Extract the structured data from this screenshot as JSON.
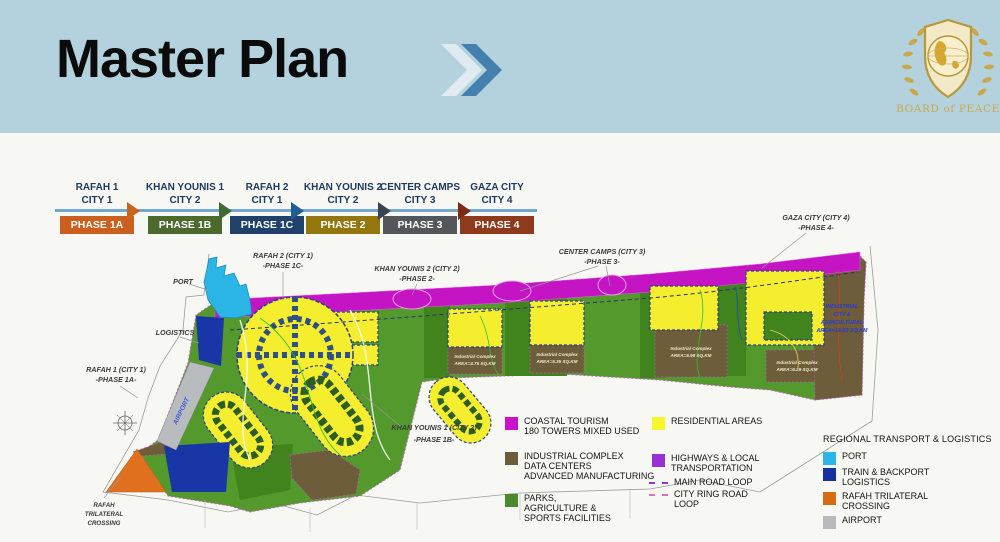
{
  "header": {
    "title": "Master Plan",
    "logo_text": "BOARD of PEACE"
  },
  "timeline": {
    "stages": [
      {
        "city_line1": "RAFAH 1",
        "city_line2": "CITY 1",
        "phase": "PHASE 1A",
        "color": "#cb5f1d"
      },
      {
        "city_line1": "KHAN YOUNIS 1",
        "city_line2": "CITY 2",
        "phase": "PHASE 1B",
        "color": "#4d6a2e"
      },
      {
        "city_line1": "RAFAH 2",
        "city_line2": "CITY 1",
        "phase": "PHASE 1C",
        "color": "#20416a"
      },
      {
        "city_line1": "KHAN YOUNIS 2",
        "city_line2": "CITY 2",
        "phase": "PHASE 2",
        "color": "#93770c"
      },
      {
        "city_line1": "CENTER CAMPS",
        "city_line2": "CITY 3",
        "phase": "PHASE 3",
        "color": "#55565a"
      },
      {
        "city_line1": "GAZA CITY",
        "city_line2": "CITY 4",
        "phase": "PHASE 4",
        "color": "#8e3a1d"
      }
    ],
    "arrows": [
      "#c9651f",
      "#3f6a33",
      "#1f5d94",
      "#3a4450",
      "#7c2a15"
    ]
  },
  "map": {
    "labels": {
      "port": "PORT",
      "logistics": "LOGISTICS",
      "airport": "AIRPORT",
      "rafah1_l1": "RAFAH 1 (CITY 1)",
      "rafah1_l2": "-PHASE 1A-",
      "rafah2_l1": "RAFAH 2 (CITY 1)",
      "rafah2_l2": "-PHASE 1C-",
      "ky1_l1": "KHAN YOUNIS 1 (CITY 2)",
      "ky1_l2": "-PHASE 1B-",
      "ky2_l1": "KHAN YOUNIS 2 (CITY 2)",
      "ky2_l2": "-PHASE 2-",
      "cc_l1": "CENTER CAMPS (CITY 3)",
      "cc_l2": "-PHASE 3-",
      "gaza_l1": "GAZA CITY (CITY 4)",
      "gaza_l2": "-PHASE 4-",
      "crossing_l1": "RAFAH",
      "crossing_l2": "TRILATERAL",
      "crossing_l3": "CROSSING"
    },
    "industrial": {
      "site1_l1": "Industrial Complex",
      "site1_l2": "AREA=4.75 SQ.KM",
      "site2_l1": "Industrial Complex",
      "site2_l2": "AREA=5.35 SQ.KM",
      "site3_l1": "Industrial Complex",
      "site3_l2": "AREA=6.98 SQ.KM",
      "site4_l1": "Industrial Complex",
      "site4_l2": "AREA=6.29 SQ.KM",
      "city_l1": "INDUSTRIAL",
      "city_l2": "CITY &",
      "city_l3": "AGRICULTURAL",
      "city_l4": "AREA=16.63 SQ.KM"
    },
    "colors": {
      "parks": "#54992b",
      "parks_dark": "#41831d",
      "residential": "#f4ee2f",
      "highway": "#c414c4",
      "industrial": "#6d5d3a",
      "port": "#2ab5e6",
      "train": "#1836a6",
      "crossing": "#e06f1e",
      "airport": "#b9bcbe"
    }
  },
  "legend": {
    "planning": {
      "coastal": {
        "c": "#cb10cb",
        "l1": "COASTAL TOURISM",
        "l2": "180 TOWERS MIXED USED"
      },
      "industrial": {
        "c": "#6d5c3b",
        "l1": "INDUSTRIAL COMPLEX",
        "l2": "DATA CENTERS",
        "l3": "ADVANCED MANUFACTURING"
      },
      "parks": {
        "c": "#4c8b2d",
        "l1": "PARKS,",
        "l2": "AGRICULTURE &",
        "l3": "SPORTS FACILITIES"
      },
      "residential": {
        "c": "#f6f62b",
        "l1": "RESIDENTIAL AREAS"
      },
      "highways": {
        "c": "#9a2fd6",
        "l1": "HIGHWAYS & LOCAL",
        "l2": "TRANSPORTATION"
      },
      "main_road": {
        "c": "#a22fd0",
        "l1": "MAIN ROAD LOOP"
      },
      "ring_road": {
        "c": "#e06ec0",
        "l1": "CITY RING ROAD",
        "l2": "LOOP"
      }
    },
    "transport": {
      "title": "REGIONAL TRANSPORT & LOGISTICS",
      "port": {
        "c": "#29b7e9",
        "l1": "PORT"
      },
      "train": {
        "c": "#16309f",
        "l1": "TRAIN & BACKPORT",
        "l2": "LOGISTICS"
      },
      "crossing": {
        "c": "#d86a14",
        "l1": "RAFAH TRILATERAL",
        "l2": "CROSSING"
      },
      "airport": {
        "c": "#b7b9bb",
        "l1": "AIRPORT"
      }
    }
  }
}
